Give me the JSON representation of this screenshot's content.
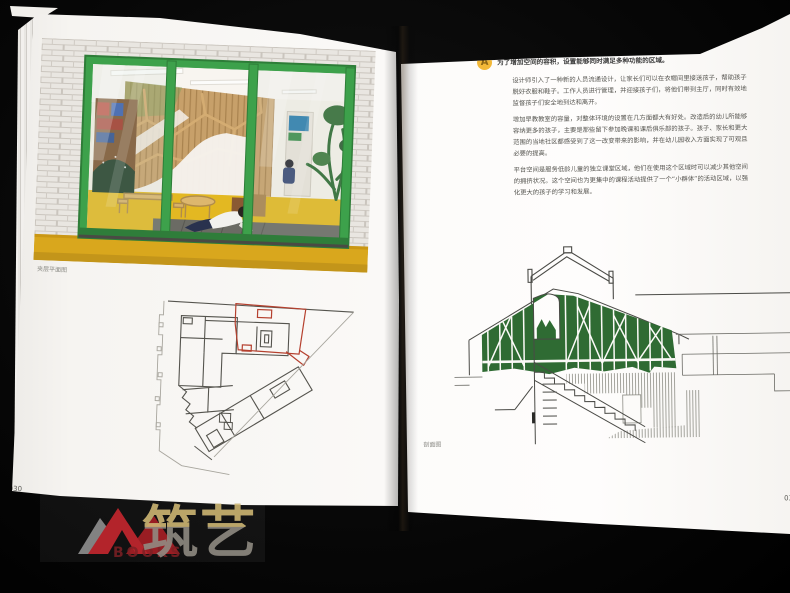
{
  "book": {
    "left_page": {
      "page_number": "030",
      "plan_caption": "夹层平面图"
    },
    "right_page": {
      "page_number": "031",
      "badge_letter": "A",
      "heading": "为了增加空间的容积，设置能够同时满足多种功能的区域。",
      "paragraphs": [
        "设计师引入了一种新的人员流通设计，让家长们可以在衣帽间里接送孩子，帮助孩子脱好衣服和鞋子。工作人员进行管理，并迎接孩子们，将他们带到主厅，同时有效地监督孩子们安全地到达和离开。",
        "增加早教教室的容量，对整体环境的设置在几方面都大有好处。改造后的幼儿所能够容纳更多的孩子，主要是那些留下参加晚课和课后俱乐部的孩子。孩子、家长和更大范围的当地社区都感受到了这一改变带来的影响，并在幼儿园收入方面实现了可观且必要的提高。",
        "平台空间是服务低龄儿童的独立课堂区域，他们在使用这个区域时可以减少其他空间的拥挤状况。这个空间也为更集中的课程活动提供了一个“小群体”的活动区域，以强化更大的孩子的学习和发展。"
      ],
      "section_caption": "剖面图"
    }
  },
  "watermark": {
    "brand": "筑艺",
    "books": "BOOKS"
  },
  "colors": {
    "door_frame_green": "#3da14b",
    "floor_yellow": "#d9a71d",
    "section_green": "#2f6b33",
    "plan_highlight_red": "#b5402e",
    "badge_amber": "#f2b838",
    "logo_red": "#b3242b",
    "background_black": "#070707"
  }
}
